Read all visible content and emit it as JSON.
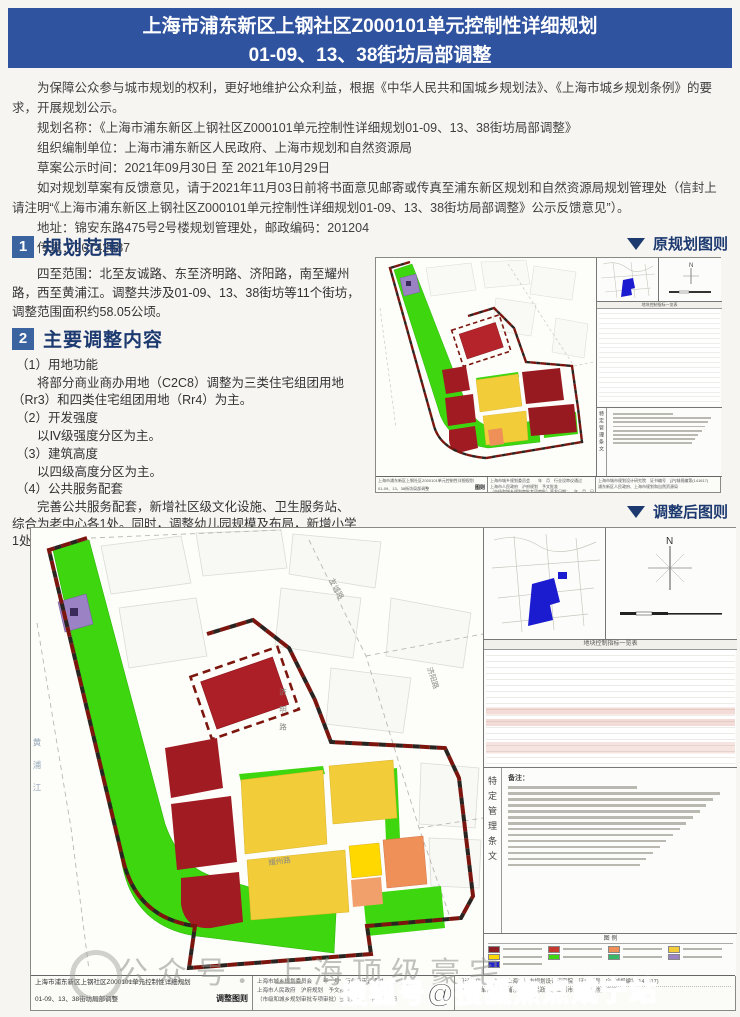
{
  "header": {
    "line1": "上海市浦东新区上钢社区Z000101单元控制性详细规划",
    "line2": "01-09、13、38街坊局部调整"
  },
  "intro": {
    "p1": "为保障公众参与城市规划的权利，更好地维护公众利益，根据《中华人民共和国城乡规划法》、《上海市城乡规划条例》的要求，开展规划公示。",
    "p2_name": "规划名称：《上海市浦东新区上钢社区Z000101单元控制性详细规划01-09、13、38街坊局部调整》",
    "p3_org": "组织编制单位：上海市浦东新区人民政府、上海市规划和自然资源局",
    "p4_time": "草案公示时间：2021年09月30日 至 2021年10月29日",
    "p5_feedback": "如对规划草案有反馈意见，请于2021年11月03日前将书面意见邮寄或传真至浦东新区规划和自然资源局规划管理处（信封上请注明“《上海市浦东新区上钢社区Z000101单元控制性详细规划01-09、13、38街坊局部调整》公示反馈意见”）。",
    "p6_addr": "地址：锦安东路475号2号楼规划管理处，邮政编码：201204",
    "p7_fax": "传真：20742587"
  },
  "section1": {
    "num": "1",
    "title": "规划范围",
    "body": "四至范围：北至友诚路、东至济明路、济阳路，南至耀州路，西至黄浦江。调整共涉及01-09、13、38街坊等11个街坊，调整范围面积约58.05公顷。"
  },
  "section2": {
    "num": "2",
    "title": "主要调整内容",
    "items": [
      {
        "h": "（1）用地功能",
        "b": "将部分商业商办用地（C2C8）调整为三类住宅组团用地（Rr3）和四类住宅组团用地（Rr4）为主。"
      },
      {
        "h": "（2）开发强度",
        "b": "以Ⅳ级强度分区为主。"
      },
      {
        "h": "（3）建筑高度",
        "b": "以四级高度分区为主。"
      },
      {
        "h": "（4）公共服务配套",
        "b": "完善公共服务配套，新增社区级文化设施、卫生服务站、综合为老中心各1处。同时，调整幼儿园规模及布局，新增小学1处。"
      }
    ]
  },
  "figure_labels": {
    "original": "原规划图则",
    "adjusted": "调整后图则"
  },
  "big_map": {
    "roads": {
      "north": "友诚路",
      "east": "济明路",
      "east2": "济阳路",
      "south": "耀州路",
      "west": "黄浦江"
    },
    "compass_n": "N",
    "table_title": "地块控制指标一览表",
    "notes_label": "备注：",
    "vertical_label": "特定管理条文",
    "legend_title": "图 例",
    "title_block": {
      "name1": "上海市浦东新区上钢社区Z000101单元控制性详细规划",
      "name2": "01-09、13、38街坊局部调整",
      "sheet": "调整图则",
      "approve1": "上海市城乡规划委员会　　年　月　行业设审议通过",
      "approve2": "上海市人民政府　沪府规划　予文批准",
      "approve3": "（市级和城乡规划审批专项审批）签发日期：　年　月　日",
      "design_label1": "设计单位",
      "design_value1": "上海市城市规划设计研究院　证书编号　[沪]城规编第(141617)",
      "design_label2": "规划编制单位",
      "design_value2": "浦东新区人民政府、上海市规划和自然资源局"
    }
  },
  "small_map": {
    "name1": "上海市浦东新区上钢社区Z000101单元控制性详细规划",
    "name2": "01-09、13、38街坊局部调整",
    "sheet": "图则",
    "compass_n": "N"
  },
  "legend_colors": [
    "#8b1f24",
    "#c7392f",
    "#ef9059",
    "#f2cd39",
    "#ffd800",
    "#3ed60f",
    "#35b868",
    "#9b82c4",
    "#2323cc"
  ],
  "watermarks": {
    "w1": "公众号．上海顶级豪宅",
    "w2": "搜狐号@搜狐焦点咸宁站"
  },
  "colors": {
    "banner_blue": "#30539f",
    "section_navy": "#1d3a70",
    "map_green": "#3ed60f",
    "parcel_dark_red": "#a01b22",
    "parcel_red": "#b5242b",
    "parcel_yellow": "#f2cd39",
    "parcel_bright_yellow": "#ffd800",
    "parcel_orange": "#ef9059",
    "parcel_purple": "#9b82c4",
    "boundary_red": "#7c150d",
    "locator_blue": "#1b1bd0"
  }
}
